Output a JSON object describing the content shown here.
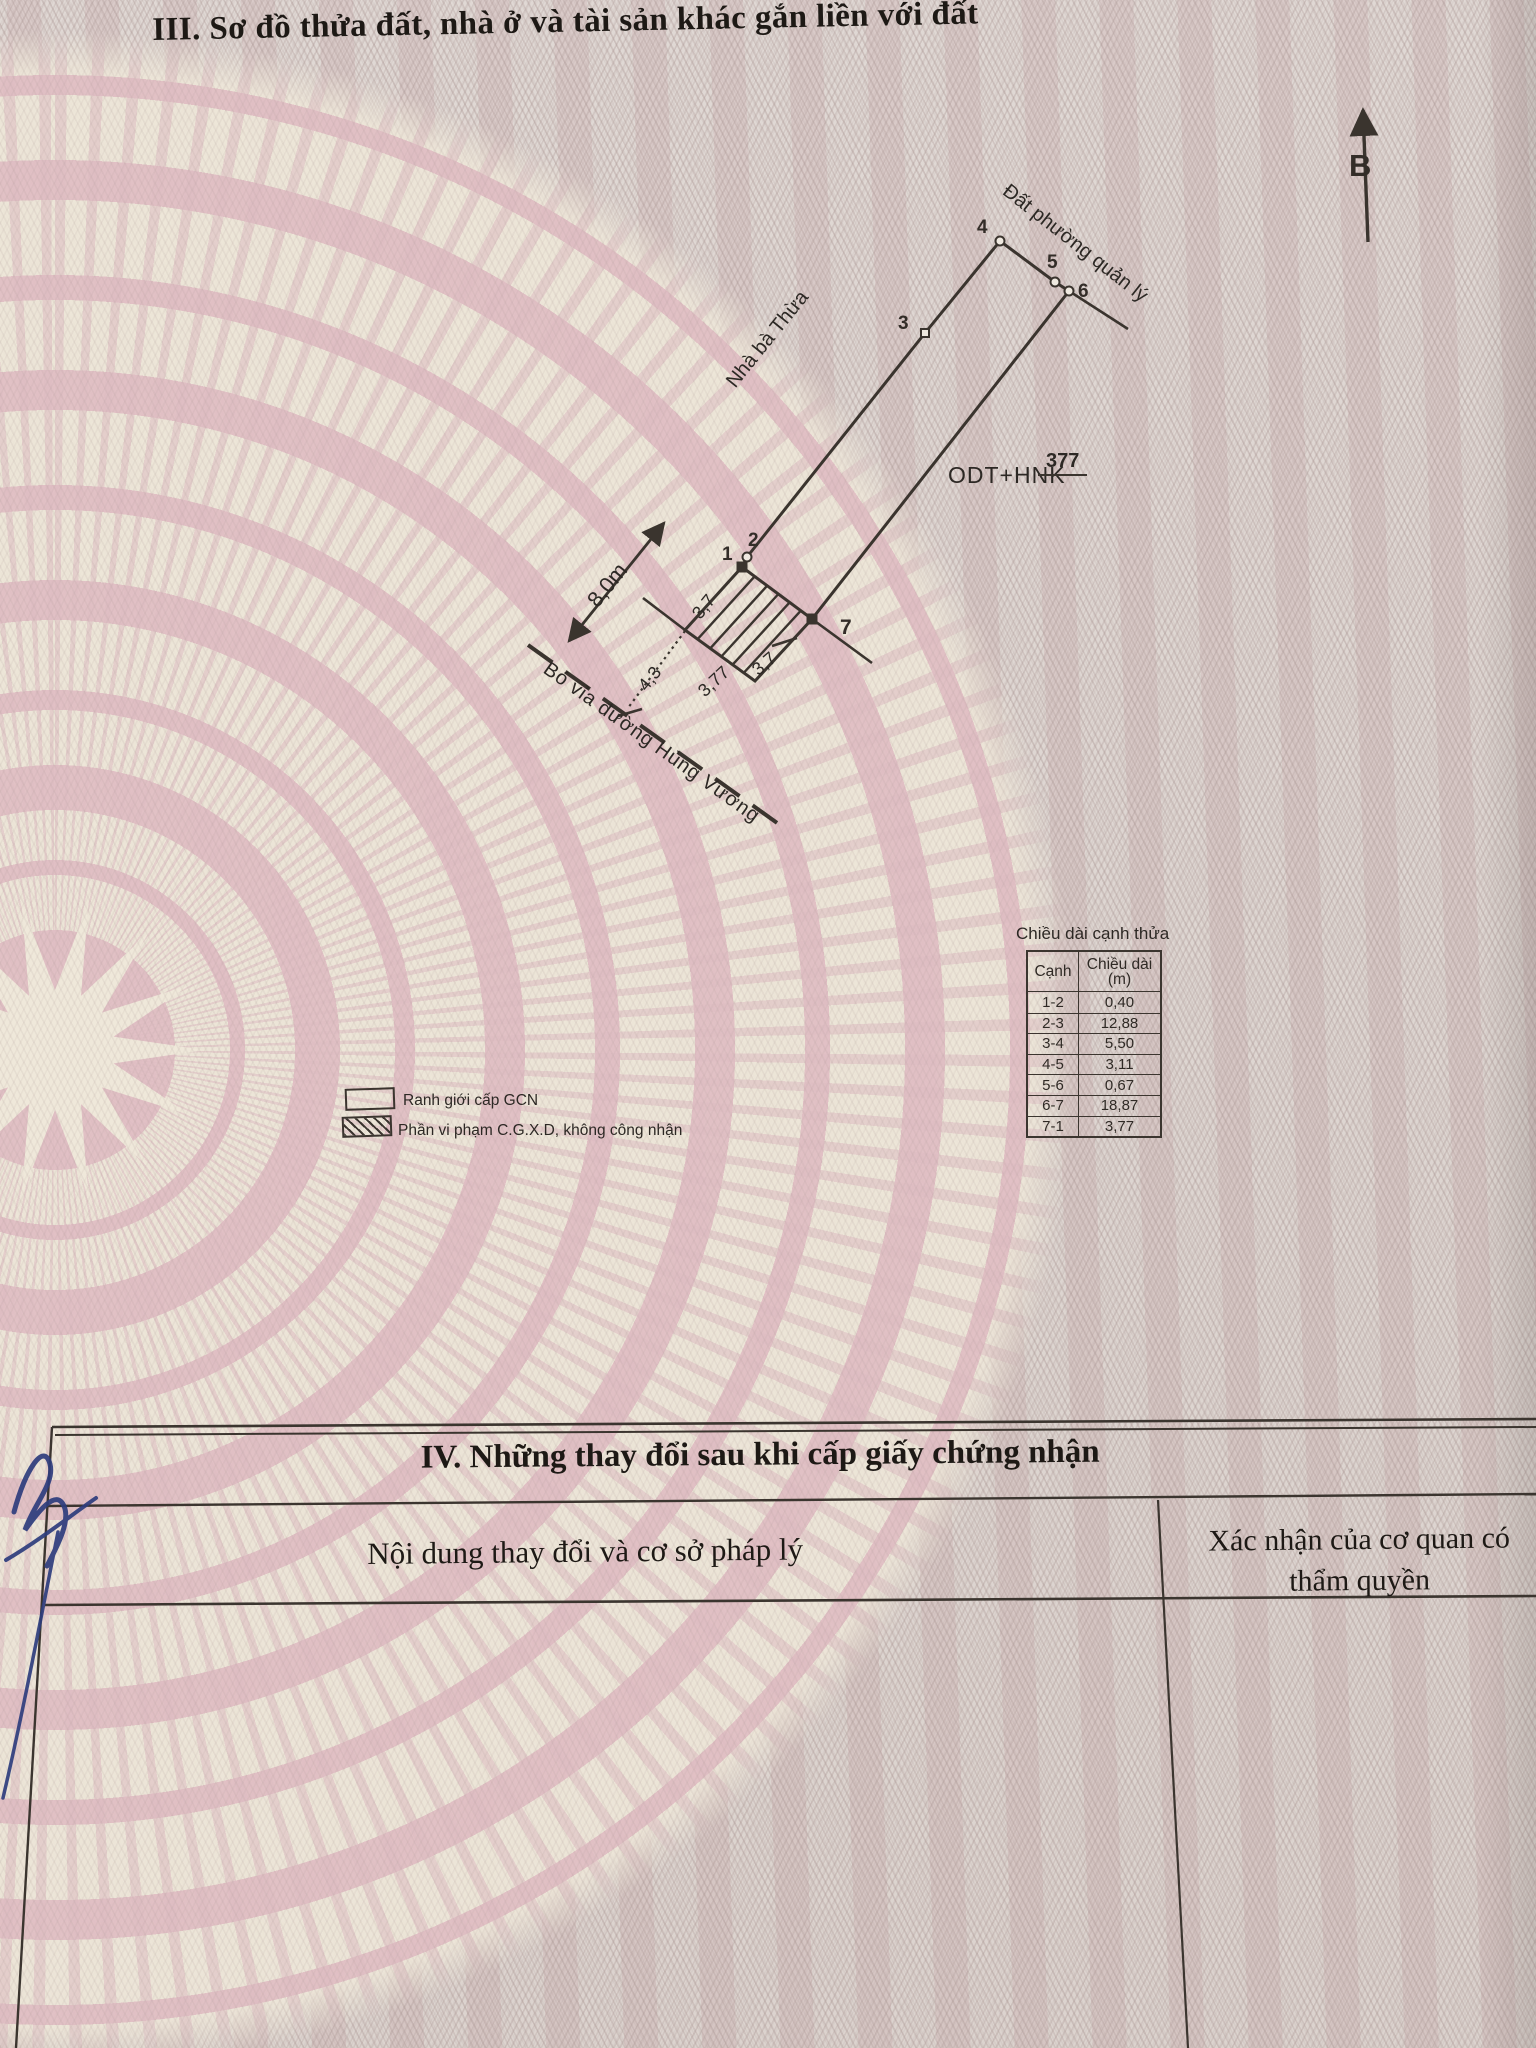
{
  "page": {
    "section3_title": "III. Sơ đồ thửa đất, nhà ở và tài sản khác gắn liền với đất",
    "section4": {
      "title": "IV. Những thay đổi sau khi cấp giấy chứng nhận",
      "col_left": "Nội dung thay đổi và cơ sở pháp lý",
      "col_right": "Xác nhận của cơ quan có thẩm quyền"
    }
  },
  "diagram": {
    "north_label": "B",
    "labels": {
      "adjacent_top": "Đất phường quản lý",
      "adjacent_left": "Nhà bà Thừa",
      "road": "Bó vỉa đường Hùng Vương",
      "land_use": "ODT+HNK",
      "parcel_number": "377",
      "dim_8m": "8,0m",
      "dim_37_left": "3,7",
      "dim_43": "4,3",
      "dim_377": "3,77",
      "dim_37_right": "3,7"
    },
    "points": [
      "1",
      "2",
      "3",
      "4",
      "5",
      "6",
      "7"
    ]
  },
  "edge_table": {
    "title": "Chiều dài cạnh thửa",
    "col1": "Cạnh",
    "col2_line1": "Chiều dài",
    "col2_line2": "(m)",
    "rows": [
      [
        "1-2",
        "0,40"
      ],
      [
        "2-3",
        "12,88"
      ],
      [
        "3-4",
        "5,50"
      ],
      [
        "4-5",
        "3,11"
      ],
      [
        "5-6",
        "0,67"
      ],
      [
        "6-7",
        "18,87"
      ],
      [
        "7-1",
        "3,77"
      ]
    ]
  },
  "legend": {
    "boundary": "Ranh giới cấp GCN",
    "violation": "Phần vi phạm C.G.X.D, không công nhận"
  },
  "colors": {
    "paper_pink": "#e2c0c5",
    "pattern_cream": "#eee7d9",
    "mesh": "#cfc5c2",
    "line": "#3a342e",
    "pen_blue": "#2e3d7d"
  }
}
